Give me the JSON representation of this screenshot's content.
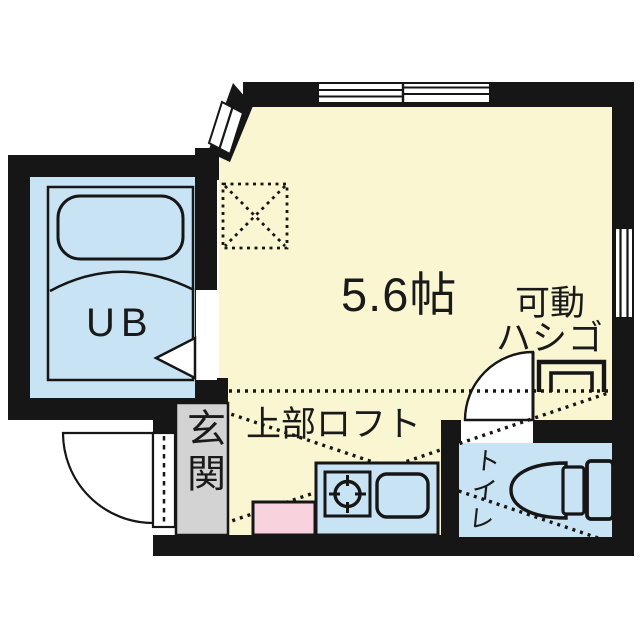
{
  "plan": {
    "main_room": {
      "size_label": "5.6帖"
    },
    "loft": {
      "label": "上部ロフト",
      "ladder_label_line1": "可動",
      "ladder_label_line2": "ハシゴ"
    },
    "unit_bath": {
      "label": "UB"
    },
    "entrance": {
      "label": "玄関"
    },
    "toilet": {
      "label": "トイレ"
    }
  },
  "colors": {
    "room_fill": "#FBF6D2",
    "wet_area_fill": "#C8E3F4",
    "washer_fill": "#F8D2DD",
    "entrance_fill": "#D3D3D3",
    "wall": "#161616",
    "background": "#FFFFFF"
  }
}
